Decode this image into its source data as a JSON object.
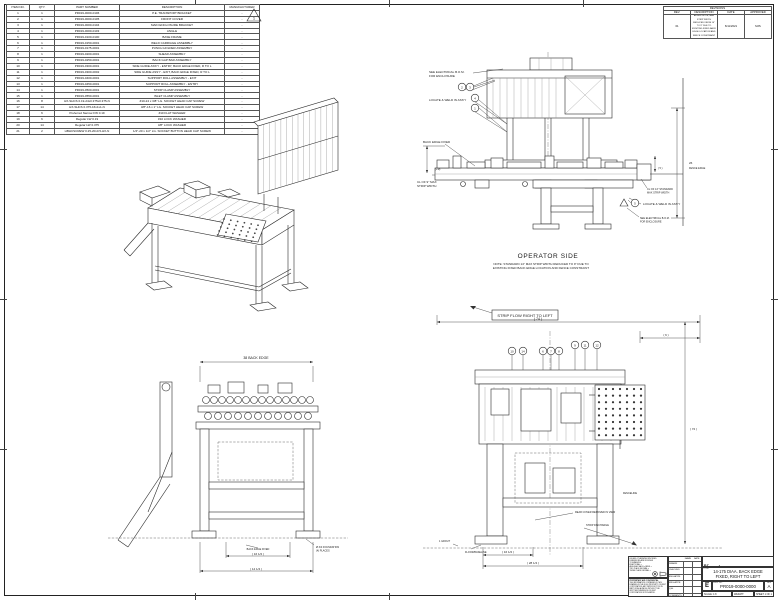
{
  "parts_list": {
    "headers": [
      "ITEM NO.",
      "QTY.",
      "PART NUMBER",
      "DESCRIPTION",
      "MANUFACTURER"
    ],
    "rows": [
      {
        "item": "1",
        "qty": "1",
        "part_number": "PR019-0000-0106",
        "description": "P.E. TRANSPORT BRACKET",
        "manufacturer": "-"
      },
      {
        "item": "2",
        "qty": "1",
        "part_number": "PR019-0000-0105",
        "description": "FRONT COVER",
        "manufacturer": "-"
      },
      {
        "item": "3",
        "qty": "1",
        "part_number": "PR019-0000-0104",
        "description": "MAIN ENCLOSURE BRACKET",
        "manufacturer": "-"
      },
      {
        "item": "4",
        "qty": "1",
        "part_number": "PR019-0000-0103",
        "description": "ANGLE",
        "manufacturer": "-"
      },
      {
        "item": "5",
        "qty": "1",
        "part_number": "PR019-0100-0100",
        "description": "BASE FRAME",
        "manufacturer": "-"
      },
      {
        "item": "6",
        "qty": "1",
        "part_number": "PR019-0150-0001",
        "description": "WELD CARRIAGE ASSEMBLY",
        "manufacturer": "-"
      },
      {
        "item": "7",
        "qty": "1",
        "part_number": "PR019-0175-0001",
        "description": "PUNCH HOLDER ASSEMBLY",
        "manufacturer": "-"
      },
      {
        "item": "8",
        "qty": "1",
        "part_number": "PR019-0200-0001",
        "description": "SHEAR ASSEMBLY",
        "manufacturer": "-"
      },
      {
        "item": "9",
        "qty": "1",
        "part_number": "PR019-0250-0001",
        "description": "BACK GAP BAR ASSEMBLY",
        "manufacturer": "-"
      },
      {
        "item": "10",
        "qty": "1",
        "part_number": "PR019-0300-0001",
        "description": "SIDE GUIDE ASS'Y - ENTRY, BACK EDGE FIXED, R TO L",
        "manufacturer": "-"
      },
      {
        "item": "11",
        "qty": "1",
        "part_number": "PR019-0300-0002",
        "description": "SIDE GUIDE ASS'Y - EXIT, BACK EDGE FIXED, R TO L",
        "manufacturer": "-"
      },
      {
        "item": "12",
        "qty": "1",
        "part_number": "PR019-0400-0001",
        "description": "SUPPORT ROLL ASSEMBLY - EXIT",
        "manufacturer": "-"
      },
      {
        "item": "13",
        "qty": "1",
        "part_number": "PR019-0450-0001",
        "description": "SUPPORT ROLL ASSEMBLY - ENTRY",
        "manufacturer": "-"
      },
      {
        "item": "14",
        "qty": "1",
        "part_number": "PR019-0500-0001",
        "description": "STRIP CLAMP ASSEMBLY",
        "manufacturer": "-"
      },
      {
        "item": "15",
        "qty": "1",
        "part_number": "PR019-0550-0001",
        "description": "INLET CLAMP ASSEMBLY",
        "manufacturer": "-"
      },
      {
        "item": "16",
        "qty": "8",
        "part_number": "HX-SHCS 0.19-24x0.375x0.375-N",
        "description": "#10-24 x 3/8\" LG. SOCKET HEAD CAP SCREW",
        "manufacturer": "-"
      },
      {
        "item": "17",
        "qty": "14",
        "part_number": "HX-SHCS 0.375-16x1x1-N",
        "description": "3/8\"-16 x 1\" LG. SOCKET HEAD CAP SCREW",
        "manufacturer": "-"
      },
      {
        "item": "18",
        "qty": "6",
        "part_number": "Preferred Narrow FW 0.19",
        "description": "#10 FLAT WASHER",
        "manufacturer": "-"
      },
      {
        "item": "19",
        "qty": "6",
        "part_number": "Regular LW 0.19",
        "description": "#10 LOCK WASHER",
        "manufacturer": "-"
      },
      {
        "item": "20",
        "qty": "14",
        "part_number": "Regular LW 0.375",
        "description": "3/8\" LOCK WASHER",
        "manufacturer": "-"
      },
      {
        "item": "21",
        "qty": "2",
        "part_number": "HBHCSCREW 0.25-20x0.5-HX-N",
        "description": "1/4\"-20 x 1/2\" LG. SOCKET BUTTON HEAD CAP SCREW",
        "manufacturer": "-"
      }
    ],
    "delta_note": "1"
  },
  "revisions": {
    "title": "REVISIONS",
    "headers": [
      "REV.",
      "DESCRIPTION",
      "DATE",
      "APPROVED"
    ],
    "row": {
      "rev": "01",
      "description": "ADDED NOTE; MAX STRIP WIDTH REDUCED FROM 14\" TO 9\" DUE TO EXISTING FIXED BACK EDGE LOCATION AND FENCE CONSTRAINT",
      "date": "6/11/2021",
      "approved": "MJS"
    }
  },
  "op": {
    "enclosure_note1a": "SEE ELECTRICAL B.O.M.",
    "enclosure_note1b": "FOR ENCLOSURE",
    "locate_weld1": "LOCATE & WELD IN ASS'Y",
    "back_edge": "BACK EDGE FIXED",
    "cl9a": "CL OF 9\" MAX",
    "cl9b": "STRIP WIDTH",
    "dim9": "(+9)",
    "dim_small": "( 5 )",
    "cl14a": "CL OF 14\" STANDARD",
    "cl14b": "MAX STRIP WIDTH",
    "locate_weld2": "LOCATE & WELD IN ASS'Y",
    "enclosure_note2a": "SEE ELECTRICAL B.O.M.",
    "enclosure_note2b": "FOR ENCLOSURE",
    "fence_dim": "26",
    "fence_label": "FENCE EDGE",
    "title": "OPERATOR SIDE",
    "note1": "NOTE: STANDARD 14\" MAX STRIP WIDTH REDUCED TO 9\" DUE TO",
    "note2": "EXISTING FIXED BACK EDGE LOCATION AND FENCE CONSTRAINT",
    "balloons": [
      "2",
      "3",
      "4",
      "1"
    ],
    "balloon_right": "5"
  },
  "side": {
    "dim_top": "38 BACK EDGE",
    "back_edge": "BACK EDGE FIXED",
    "dim16": "( 16 1/2 )",
    "found1": "Ø 3/4 FOUNDATION",
    "found2": "(4) PLACES",
    "dim_bottom": "( 14 1/4 )"
  },
  "front": {
    "strip_flow": "STRIP FLOW RIGHT TO LEFT",
    "dim74": "( 74 )",
    "dim6": "( 6 )",
    "dim72": "( 72 )",
    "fenceline": "FENCELINE",
    "rear_cover": "REAR COVER REMOVED IN VIEW",
    "discharge": "STRIP DISCHARGE",
    "grout": "1 GROUT",
    "floor": "FLOOR/BASELINE",
    "dim16": "( 16 1/2 )",
    "dim28": "( 28 1/4 )",
    "balloons": [
      "10",
      "14",
      "6",
      "7",
      "8",
      "9",
      "11",
      "12"
    ]
  },
  "tb": {
    "company": "Kent",
    "tagline": "CORPORATION",
    "title_label": "TITLE:",
    "title1": "14-175 DIAA. BACK EDGE",
    "title2": "FIXED, RIGHT TO LEFT",
    "size_label": "SIZE",
    "size": "E",
    "dwg_label": "DWG. NO.",
    "dwg_no": "PR019-0000-0000",
    "rev_label": "REV",
    "rev": "A",
    "scale": "SCALE: 1:8",
    "weight": "WEIGHT:",
    "sheet": "SHEET 1 OF 1",
    "uos1": "UNLESS OTHERWISE SPECIFIED:",
    "uos2": "DIMENSIONS ARE IN INCHES",
    "uos3": "TOLERANCES:",
    "uos4": "FRACTIONAL ±",
    "uos5": "ANGULAR: MACH ±  BEND ±",
    "uos6": "TWO PLACE DECIMAL    ±",
    "uos7": "THREE PLACE DECIMAL  ±",
    "prop_title": "PROPRIETARY AND CONFIDENTIAL",
    "prop_body": "THE INFORMATION CONTAINED IN THIS DRAWING IS THE SOLE PROPERTY OF KENT CORPORATION. ANY REPRODUCTION IN PART OR AS A WHOLE WITHOUT THE WRITTEN PERMISSION OF KENT CORPORATION IS PROHIBITED.",
    "name_h": "NAME",
    "date_h": "DATE",
    "rows": [
      "DRAWN",
      "CHECKED",
      "ENG APPR.",
      "MFG APPR.",
      "Q.A.",
      "COMMENTS:"
    ]
  }
}
